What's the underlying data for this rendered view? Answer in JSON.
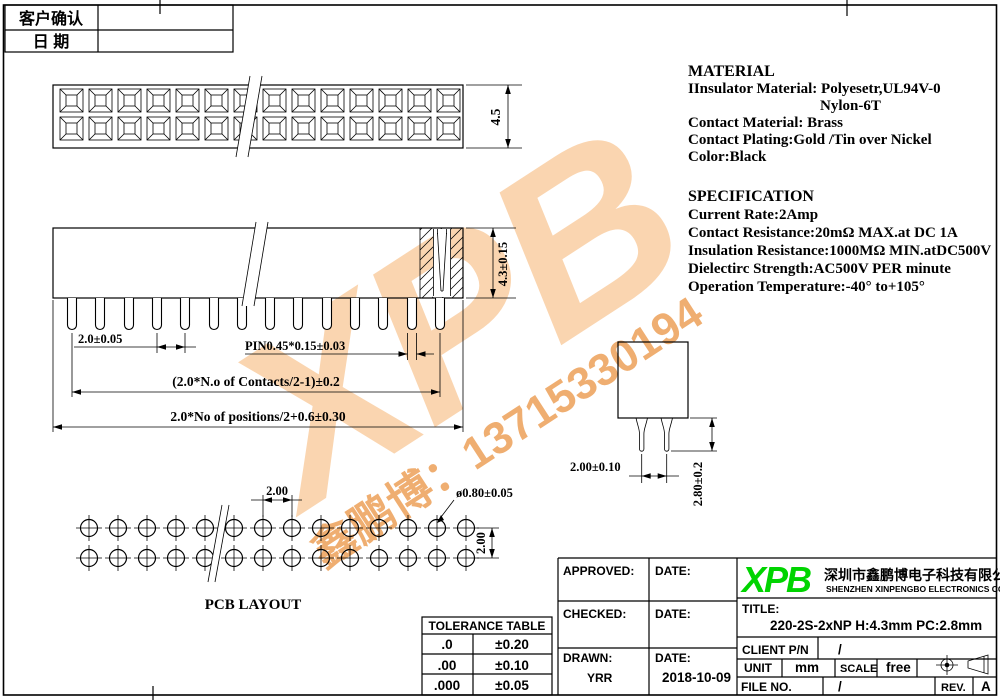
{
  "confirm_table": {
    "rows": [
      "客户确认",
      "日  期"
    ]
  },
  "material": {
    "heading": "MATERIAL",
    "lines": [
      "IInsulator Material: Polyesetr,UL94V-0",
      "Nylon-6T",
      "Contact Material:  Brass",
      "Contact Plating:Gold /Tin over Nickel",
      "Color:Black"
    ]
  },
  "specification": {
    "heading": "SPECIFICATION",
    "lines": [
      "Current Rate:2Amp",
      "Contact Resistance:20mΩ  MAX.at DC 1A",
      "Insulation Resistance:1000MΩ MIN.atDC500V",
      "Dielectirc Strength:AC500V PER minute",
      "Operation Temperature:-40° to+105°"
    ]
  },
  "views": {
    "top": {
      "height_dim": "4.5"
    },
    "side": {
      "height_dim": "4.3±0.15",
      "pitch_dim": "2.0±0.05",
      "pin_dim": "PIN0.45*0.15±0.03",
      "contacts_dim": "(2.0*N.o of Contacts/2-1)±0.2",
      "total_dim": "2.0*No of positions/2+0.6±0.30"
    },
    "end": {
      "spacing_dim": "2.00±0.10",
      "leg_dim": "2.80±0.2"
    },
    "pcb": {
      "pitch_h": "2.00",
      "hole_dim": "ø0.80±0.05",
      "pitch_v": "2.00",
      "label": "PCB  LAYOUT"
    },
    "geometry": {
      "positions_per_row": 14,
      "rows": 2
    }
  },
  "tolerance_table": {
    "title": "TOLERANCE TABLE",
    "rows": [
      {
        "digits": ".0",
        "tol": "±0.20"
      },
      {
        "digits": ".00",
        "tol": "±0.10"
      },
      {
        "digits": ".000",
        "tol": "±0.05"
      }
    ]
  },
  "title_block": {
    "approved_label": "APPROVED:",
    "checked_label": "CHECKED:",
    "drawn_label": "DRAWN:",
    "drawn_value": "YRR",
    "date_label": "DATE:",
    "date_value": "2018-10-09",
    "logo": "XPB",
    "company_cn": "深圳市鑫鹏博电子科技有限公司",
    "company_en": "SHENZHEN XINPENGBO ELECTRONICS CO.LTD",
    "title_label": "TITLE:",
    "title_value": "220-2S-2xNP H:4.3mm PC:2.8mm",
    "client_label": "CLIENT P/N",
    "client_value": "/",
    "unit_label": "UNIT",
    "unit_value": "mm",
    "scale_label": "SCALE",
    "scale_value": "free",
    "file_label": "FILE NO.",
    "file_value": "/",
    "rev_label": "REV.",
    "rev_value": "A"
  },
  "watermark": {
    "logo": "XPB",
    "contact": "鑫鹏博：13715330194",
    "color_light": "#f5a85c",
    "color_strong": "#ec9b4e"
  },
  "colors": {
    "logo_green": "#00d400",
    "line": "#000000"
  }
}
